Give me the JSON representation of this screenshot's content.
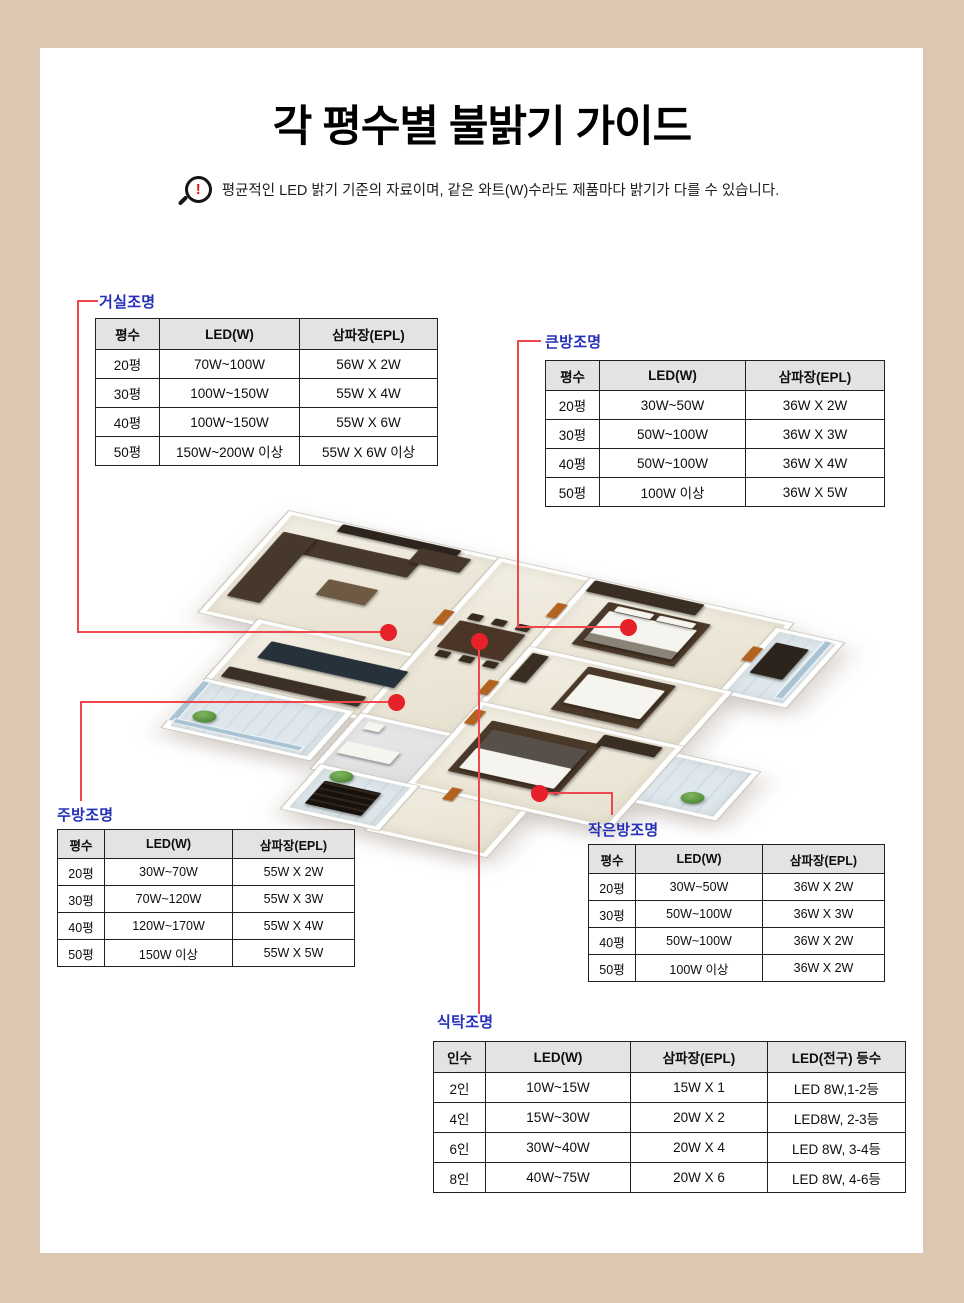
{
  "page": {
    "title": "각 평수별 불밝기 가이드",
    "notice": "평균적인 LED 밝기 기준의 자료이며, 같은 와트(W)수라도 제품마다 밝기가 다를 수 있습니다.",
    "notice_icon_glyph": "!"
  },
  "colors": {
    "page_background": "#dcc7b2",
    "panel": "#ffffff",
    "label_blue": "#2531b8",
    "line_red": "#f0474c",
    "dot_red": "#e7212a",
    "table_header_gray": "#e3e3e3",
    "table_border": "#1f1f1f"
  },
  "tables": {
    "living": {
      "label": "거실조명",
      "headers": [
        "평수",
        "LED(W)",
        "삼파장(EPL)"
      ],
      "rows": [
        [
          "20평",
          "70W~100W",
          "56W X 2W"
        ],
        [
          "30평",
          "100W~150W",
          "55W X 4W"
        ],
        [
          "40평",
          "100W~150W",
          "55W X 6W"
        ],
        [
          "50평",
          "150W~200W 이상",
          "55W X 6W 이상"
        ]
      ]
    },
    "bigroom": {
      "label": "큰방조명",
      "headers": [
        "평수",
        "LED(W)",
        "삼파장(EPL)"
      ],
      "rows": [
        [
          "20평",
          "30W~50W",
          "36W X 2W"
        ],
        [
          "30평",
          "50W~100W",
          "36W X 3W"
        ],
        [
          "40평",
          "50W~100W",
          "36W X 4W"
        ],
        [
          "50평",
          "100W 이상",
          "36W X 5W"
        ]
      ]
    },
    "kitchen": {
      "label": "주방조명",
      "headers": [
        "평수",
        "LED(W)",
        "삼파장(EPL)"
      ],
      "rows": [
        [
          "20평",
          "30W~70W",
          "55W X 2W"
        ],
        [
          "30평",
          "70W~120W",
          "55W X 3W"
        ],
        [
          "40평",
          "120W~170W",
          "55W X 4W"
        ],
        [
          "50평",
          "150W 이상",
          "55W X 5W"
        ]
      ]
    },
    "smallroom": {
      "label": "작은방조명",
      "headers": [
        "평수",
        "LED(W)",
        "삼파장(EPL)"
      ],
      "rows": [
        [
          "20평",
          "30W~50W",
          "36W X 2W"
        ],
        [
          "30평",
          "50W~100W",
          "36W X 3W"
        ],
        [
          "40평",
          "50W~100W",
          "36W X 2W"
        ],
        [
          "50평",
          "100W 이상",
          "36W X 2W"
        ]
      ]
    },
    "dining": {
      "label": "식탁조명",
      "headers": [
        "인수",
        "LED(W)",
        "삼파장(EPL)",
        "LED(전구) 등수"
      ],
      "rows": [
        [
          "2인",
          "10W~15W",
          "15W X 1",
          "LED 8W,1-2등"
        ],
        [
          "4인",
          "15W~30W",
          "20W X 2",
          "LED8W, 2-3등"
        ],
        [
          "6인",
          "30W~40W",
          "20W X 4",
          "LED 8W, 3-4등"
        ],
        [
          "8인",
          "40W~75W",
          "20W X 6",
          "LED 8W, 4-6등"
        ]
      ]
    }
  }
}
